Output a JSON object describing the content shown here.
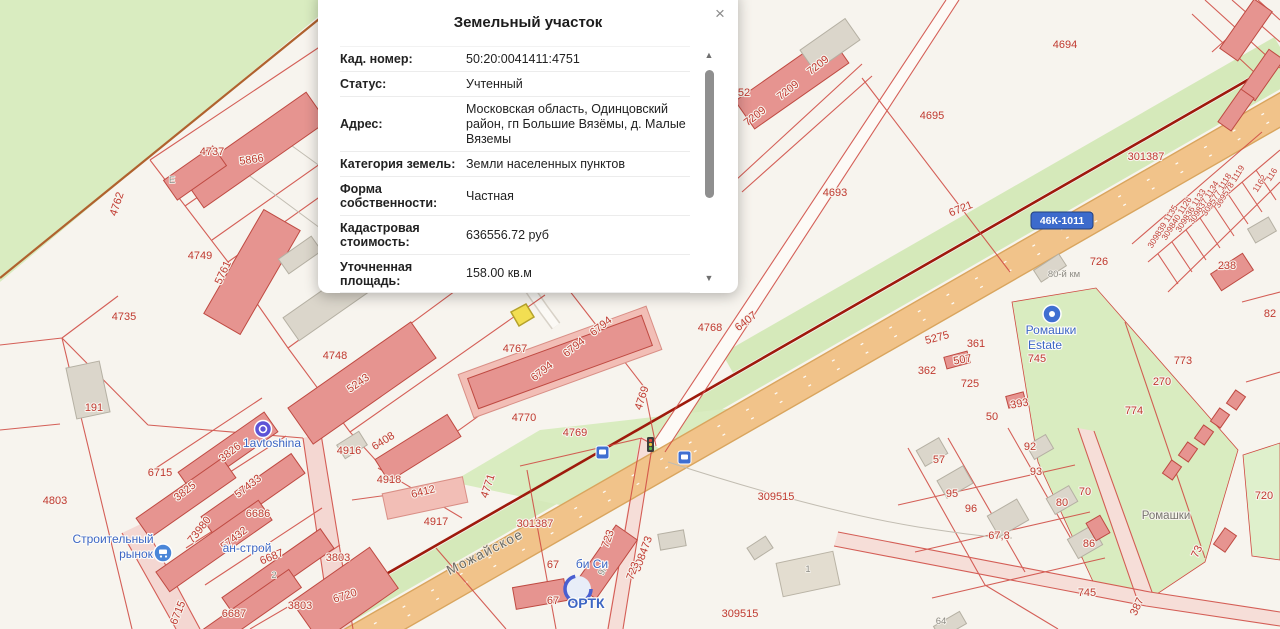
{
  "popup": {
    "title": "Земельный участок",
    "close_symbol": "×",
    "scroll_up_symbol": "▲",
    "scroll_down_symbol": "▼",
    "rows": [
      {
        "label": "Кад. номер:",
        "value": "50:20:0041411:4751"
      },
      {
        "label": "Статус:",
        "value": "Учтенный"
      },
      {
        "label": "Адрес:",
        "value": "Московская область, Одинцовский район, гп Большие Вязёмы, д. Малые Вяземы"
      },
      {
        "label": "Категория земель:",
        "value": "Земли населенных пунктов"
      },
      {
        "label": "Форма собственности:",
        "value": "Частная"
      },
      {
        "label": "Кадастровая стоимость:",
        "value": "636556.72 руб"
      },
      {
        "label": "Уточненная площадь:",
        "value": "158.00 кв.м"
      }
    ]
  },
  "map": {
    "road_shield": {
      "text": "46К-1011"
    },
    "colors": {
      "parcel_line": "#cf4a42",
      "parcel_label": "#c03a30",
      "highway": "#f1c38a",
      "greenery": "#d9ecc0",
      "building_pink": "#e69490",
      "building_grey": "#dbd6cb",
      "selected_parcel": "#f2de52",
      "boundary_dark": "#9e1a0c",
      "poi_blue": "#3d66c4",
      "shield_blue": "#3d6bcc",
      "background": "#f7f4ee"
    },
    "labels": [
      {
        "t": "4737",
        "x": 212,
        "y": 155,
        "r": 0,
        "c": "red"
      },
      {
        "t": "5866",
        "x": 252,
        "y": 163,
        "r": -8,
        "c": "red"
      },
      {
        "t": "4762",
        "x": 120,
        "y": 205,
        "r": -72,
        "c": "red"
      },
      {
        "t": "4749",
        "x": 200,
        "y": 259,
        "r": 0,
        "c": "red"
      },
      {
        "t": "5761",
        "x": 226,
        "y": 274,
        "r": -65,
        "c": "red"
      },
      {
        "t": "4735",
        "x": 124,
        "y": 320,
        "r": 0,
        "c": "red"
      },
      {
        "t": "4748",
        "x": 335,
        "y": 359,
        "r": 0,
        "c": "red"
      },
      {
        "t": "5243",
        "x": 360,
        "y": 386,
        "r": -35,
        "c": "red"
      },
      {
        "t": "191",
        "x": 94,
        "y": 411,
        "r": 0,
        "c": "red"
      },
      {
        "t": "4803",
        "x": 55,
        "y": 504,
        "r": 0,
        "c": "red"
      },
      {
        "t": "6715",
        "x": 160,
        "y": 476,
        "r": 0,
        "c": "red"
      },
      {
        "t": "3826",
        "x": 232,
        "y": 455,
        "r": -38,
        "c": "red"
      },
      {
        "t": "3825",
        "x": 187,
        "y": 494,
        "r": -38,
        "c": "red"
      },
      {
        "t": "57433",
        "x": 250,
        "y": 489,
        "r": -38,
        "c": "red"
      },
      {
        "t": "73980",
        "x": 202,
        "y": 532,
        "r": -52,
        "c": "red"
      },
      {
        "t": "6686",
        "x": 258,
        "y": 517,
        "r": 0,
        "c": "red"
      },
      {
        "t": "57432",
        "x": 236,
        "y": 541,
        "r": -38,
        "c": "red"
      },
      {
        "t": "6687",
        "x": 273,
        "y": 560,
        "r": -22,
        "c": "red"
      },
      {
        "t": "6715",
        "x": 181,
        "y": 614,
        "r": -68,
        "c": "red"
      },
      {
        "t": "6687",
        "x": 234,
        "y": 617,
        "r": 0,
        "c": "red"
      },
      {
        "t": "3803",
        "x": 300,
        "y": 609,
        "r": 0,
        "c": "red"
      },
      {
        "t": "3803",
        "x": 338,
        "y": 561,
        "r": 0,
        "c": "red"
      },
      {
        "t": "6720",
        "x": 346,
        "y": 599,
        "r": -18,
        "c": "red"
      },
      {
        "t": "4916",
        "x": 349,
        "y": 454,
        "r": 0,
        "c": "red"
      },
      {
        "t": "6408",
        "x": 385,
        "y": 444,
        "r": -32,
        "c": "red"
      },
      {
        "t": "4918",
        "x": 389,
        "y": 483,
        "r": 0,
        "c": "red"
      },
      {
        "t": "6412",
        "x": 424,
        "y": 495,
        "r": -14,
        "c": "red"
      },
      {
        "t": "4917",
        "x": 436,
        "y": 525,
        "r": 0,
        "c": "red"
      },
      {
        "t": "4767",
        "x": 515,
        "y": 352,
        "r": 0,
        "c": "red"
      },
      {
        "t": "6794",
        "x": 544,
        "y": 374,
        "r": -38,
        "c": "red"
      },
      {
        "t": "6794",
        "x": 576,
        "y": 350,
        "r": -38,
        "c": "red"
      },
      {
        "t": "6794",
        "x": 603,
        "y": 329,
        "r": -38,
        "c": "red"
      },
      {
        "t": "4768",
        "x": 710,
        "y": 331,
        "r": 0,
        "c": "red"
      },
      {
        "t": "6407",
        "x": 748,
        "y": 324,
        "r": -38,
        "c": "red"
      },
      {
        "t": "7209",
        "x": 757,
        "y": 119,
        "r": -38,
        "c": "red"
      },
      {
        "t": "7209",
        "x": 790,
        "y": 93,
        "r": -38,
        "c": "red"
      },
      {
        "t": "7209",
        "x": 820,
        "y": 68,
        "r": -38,
        "c": "red"
      },
      {
        "t": "52",
        "x": 744,
        "y": 96,
        "r": 0,
        "c": "red"
      },
      {
        "t": "4770",
        "x": 524,
        "y": 421,
        "r": 0,
        "c": "red"
      },
      {
        "t": "4769",
        "x": 575,
        "y": 436,
        "r": 0,
        "c": "red"
      },
      {
        "t": "4769",
        "x": 645,
        "y": 399,
        "r": -72,
        "c": "red"
      },
      {
        "t": "4771",
        "x": 491,
        "y": 487,
        "r": -72,
        "c": "red"
      },
      {
        "t": "301387",
        "x": 535,
        "y": 527,
        "r": 0,
        "c": "red"
      },
      {
        "t": "301387",
        "x": 1146,
        "y": 160,
        "r": 0,
        "c": "red"
      },
      {
        "t": "309515",
        "x": 776,
        "y": 500,
        "r": 0,
        "c": "red"
      },
      {
        "t": "309515",
        "x": 740,
        "y": 617,
        "r": 0,
        "c": "red"
      },
      {
        "t": "723",
        "x": 611,
        "y": 540,
        "r": -70,
        "c": "red"
      },
      {
        "t": "308473",
        "x": 646,
        "y": 555,
        "r": -70,
        "c": "red"
      },
      {
        "t": "723",
        "x": 636,
        "y": 572,
        "r": -70,
        "c": "red"
      },
      {
        "t": "67",
        "x": 553,
        "y": 568,
        "r": 0,
        "c": "red"
      },
      {
        "t": "67",
        "x": 553,
        "y": 604,
        "r": 0,
        "c": "red"
      },
      {
        "t": "4695",
        "x": 932,
        "y": 119,
        "r": 0,
        "c": "red"
      },
      {
        "t": "4693",
        "x": 835,
        "y": 196,
        "r": 0,
        "c": "red"
      },
      {
        "t": "6721",
        "x": 962,
        "y": 212,
        "r": -22,
        "c": "red"
      },
      {
        "t": "4694",
        "x": 1065,
        "y": 48,
        "r": 0,
        "c": "red"
      },
      {
        "t": "726",
        "x": 1099,
        "y": 265,
        "r": 0,
        "c": "red"
      },
      {
        "t": "238",
        "x": 1227,
        "y": 269,
        "r": 0,
        "c": "red"
      },
      {
        "t": "82",
        "x": 1270,
        "y": 317,
        "r": 0,
        "c": "red"
      },
      {
        "t": "5275",
        "x": 938,
        "y": 341,
        "r": -15,
        "c": "red"
      },
      {
        "t": "361",
        "x": 976,
        "y": 347,
        "r": 0,
        "c": "red"
      },
      {
        "t": "507",
        "x": 963,
        "y": 363,
        "r": -10,
        "c": "red"
      },
      {
        "t": "362",
        "x": 927,
        "y": 374,
        "r": 0,
        "c": "red"
      },
      {
        "t": "725",
        "x": 970,
        "y": 387,
        "r": 0,
        "c": "red"
      },
      {
        "t": "745",
        "x": 1037,
        "y": 362,
        "r": 0,
        "c": "red"
      },
      {
        "t": "393",
        "x": 1020,
        "y": 407,
        "r": -10,
        "c": "red"
      },
      {
        "t": "50",
        "x": 992,
        "y": 420,
        "r": 0,
        "c": "red"
      },
      {
        "t": "92",
        "x": 1030,
        "y": 450,
        "r": 0,
        "c": "red"
      },
      {
        "t": "93",
        "x": 1036,
        "y": 475,
        "r": 0,
        "c": "red"
      },
      {
        "t": "57",
        "x": 939,
        "y": 463,
        "r": 0,
        "c": "red"
      },
      {
        "t": "95",
        "x": 952,
        "y": 497,
        "r": 0,
        "c": "red"
      },
      {
        "t": "96",
        "x": 971,
        "y": 512,
        "r": 0,
        "c": "red"
      },
      {
        "t": "67,8",
        "x": 999,
        "y": 539,
        "r": 0,
        "c": "red"
      },
      {
        "t": "80",
        "x": 1062,
        "y": 506,
        "r": 0,
        "c": "red"
      },
      {
        "t": "70",
        "x": 1085,
        "y": 495,
        "r": 0,
        "c": "red"
      },
      {
        "t": "86",
        "x": 1089,
        "y": 547,
        "r": 0,
        "c": "red"
      },
      {
        "t": "73",
        "x": 1200,
        "y": 553,
        "r": -65,
        "c": "red"
      },
      {
        "t": "720",
        "x": 1264,
        "y": 499,
        "r": 0,
        "c": "red"
      },
      {
        "t": "745",
        "x": 1087,
        "y": 596,
        "r": 0,
        "c": "red"
      },
      {
        "t": "387",
        "x": 1140,
        "y": 608,
        "r": -65,
        "c": "red"
      },
      {
        "t": "270",
        "x": 1162,
        "y": 385,
        "r": 0,
        "c": "red"
      },
      {
        "t": "773",
        "x": 1183,
        "y": 364,
        "r": 0,
        "c": "red"
      },
      {
        "t": "774",
        "x": 1134,
        "y": 414,
        "r": 0,
        "c": "red"
      },
      {
        "t": "309578 1119",
        "x": 1232,
        "y": 188,
        "r": -58,
        "c": "redsm"
      },
      {
        "t": "309577 1118",
        "x": 1219,
        "y": 196,
        "r": -58,
        "c": "redsm"
      },
      {
        "t": "309837 1134",
        "x": 1206,
        "y": 204,
        "r": -58,
        "c": "redsm"
      },
      {
        "t": "309836 1133",
        "x": 1193,
        "y": 212,
        "r": -58,
        "c": "redsm"
      },
      {
        "t": "309840 1126",
        "x": 1179,
        "y": 220,
        "r": -58,
        "c": "redsm"
      },
      {
        "t": "309839 1135",
        "x": 1165,
        "y": 228,
        "r": -58,
        "c": "redsm"
      },
      {
        "t": "1162",
        "x": 1262,
        "y": 185,
        "r": -58,
        "c": "redsm"
      },
      {
        "t": "116",
        "x": 1274,
        "y": 176,
        "r": -58,
        "c": "redsm"
      },
      {
        "t": "Можайское",
        "x": 487,
        "y": 556,
        "r": -27,
        "c": "street"
      },
      {
        "t": "Ромашки",
        "x": 1166,
        "y": 519,
        "r": 0,
        "c": "grey"
      },
      {
        "t": "80-й км",
        "x": 1064,
        "y": 277,
        "r": 0,
        "c": "greysm"
      },
      {
        "t": "1",
        "x": 808,
        "y": 572,
        "r": 0,
        "c": "greysm"
      },
      {
        "t": "2",
        "x": 274,
        "y": 578,
        "r": 0,
        "c": "greysm"
      },
      {
        "t": "E",
        "x": 172,
        "y": 183,
        "r": 0,
        "c": "greysm"
      },
      {
        "t": "9/6",
        "x": 606,
        "y": 570,
        "r": -65,
        "c": "greysm"
      },
      {
        "t": "64",
        "x": 941,
        "y": 624,
        "r": 0,
        "c": "greysm"
      },
      {
        "t": "1avtoshina",
        "x": 272,
        "y": 447,
        "r": 0,
        "c": "blue"
      },
      {
        "t": "Строительный",
        "x": 113,
        "y": 543,
        "r": 0,
        "c": "blue"
      },
      {
        "t": "рынок",
        "x": 136,
        "y": 558,
        "r": 0,
        "c": "blue"
      },
      {
        "t": "ан-строй",
        "x": 247,
        "y": 552,
        "r": 0,
        "c": "blue"
      },
      {
        "t": "би Си",
        "x": 592,
        "y": 568,
        "r": 0,
        "c": "blue"
      },
      {
        "t": "ОРТК",
        "x": 586,
        "y": 608,
        "r": 0,
        "c": "bluelg"
      },
      {
        "t": "Ромашки",
        "x": 1051,
        "y": 334,
        "r": 0,
        "c": "blue"
      },
      {
        "t": "Estate",
        "x": 1045,
        "y": 349,
        "r": 0,
        "c": "blue"
      },
      {
        "t": "46К-1011",
        "x": 1062,
        "y": 224,
        "r": 0,
        "c": "shield"
      }
    ]
  }
}
